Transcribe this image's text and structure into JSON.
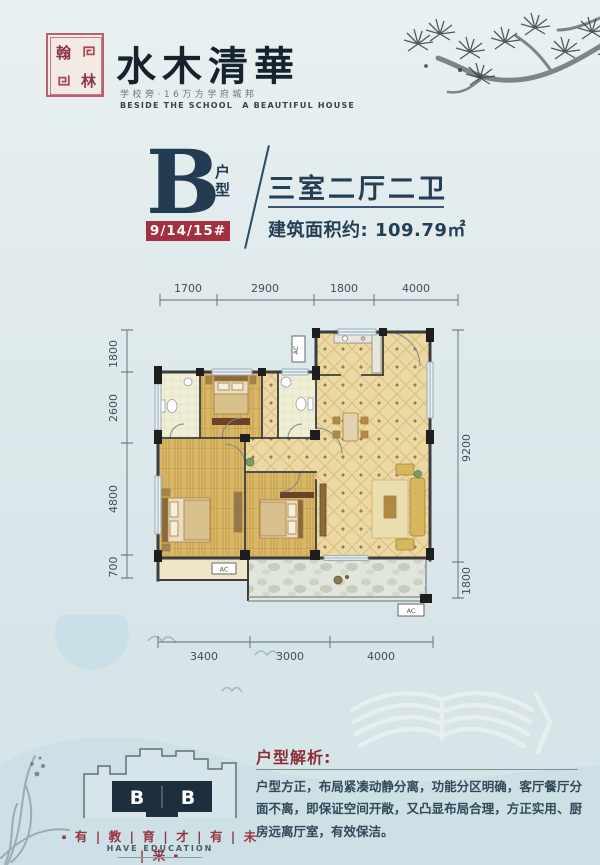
{
  "brand": {
    "seal_chars": [
      "翰",
      "林"
    ],
    "title": "水木清華",
    "subtitle_cn": "学校旁·16万方学府城邦",
    "subtitle_en": "BESIDE THE SCHOOL　A BEAUTIFUL HOUSE"
  },
  "unit": {
    "letter": "B",
    "type_label": "户型",
    "buildings": "9/14/15#",
    "layout": "三室二厅二卫",
    "area_label": "建筑面积约: 109.79㎡"
  },
  "floorplan": {
    "dims_top": [
      "1700",
      "2900",
      "1800",
      "4000"
    ],
    "dims_left": [
      "1800",
      "2600",
      "4800",
      "700"
    ],
    "dims_right": [
      "9200",
      "1800"
    ],
    "dims_bottom": [
      "3400",
      "3000",
      "4000"
    ],
    "ac_label": "AC"
  },
  "analysis": {
    "heading": "户型解析:",
    "body": "户型方正，布局紧凑动静分离，功能分区明确，客厅餐厅分面不离，即保证空间开敞，又凸显布局合理，方正实用、厨房远离厅室，有效保洁。"
  },
  "footer": {
    "tower_label_left": "B",
    "tower_label_right": "B",
    "slogan_bullet": "▪",
    "slogan_display": "有 | 教 | 育 | 才 | 有 | 未 | 来",
    "slogan_en": "HAVE EDUCATION"
  },
  "colors": {
    "accent_red": "#a3303e",
    "navy": "#243e54",
    "tile": "#ecd8a2",
    "wood": "#d8b868",
    "background": "#dbe7ea"
  }
}
